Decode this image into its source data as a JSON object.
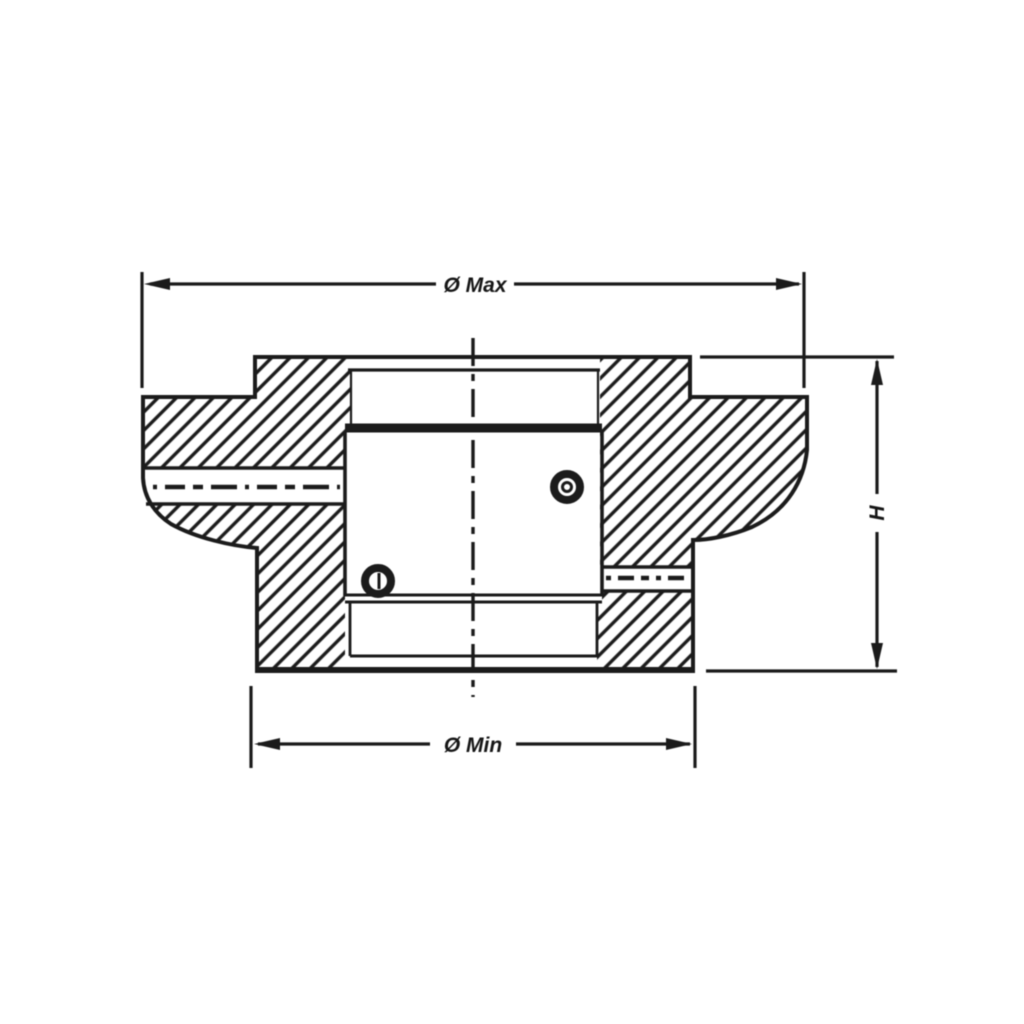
{
  "page": {
    "background": "#ffffff"
  },
  "drawing": {
    "kind": "cross-section of flanged hub with center bore",
    "line_color": "#1b1b1b",
    "hatch_color": "#1b1b1b",
    "labels": {
      "dia_max": "Ø Max",
      "dia_min": "Ø Min",
      "height": "H"
    },
    "icons": {
      "left_marker": "set-screw-hole-marker",
      "right_marker": "set-screw-hole-marker"
    }
  }
}
